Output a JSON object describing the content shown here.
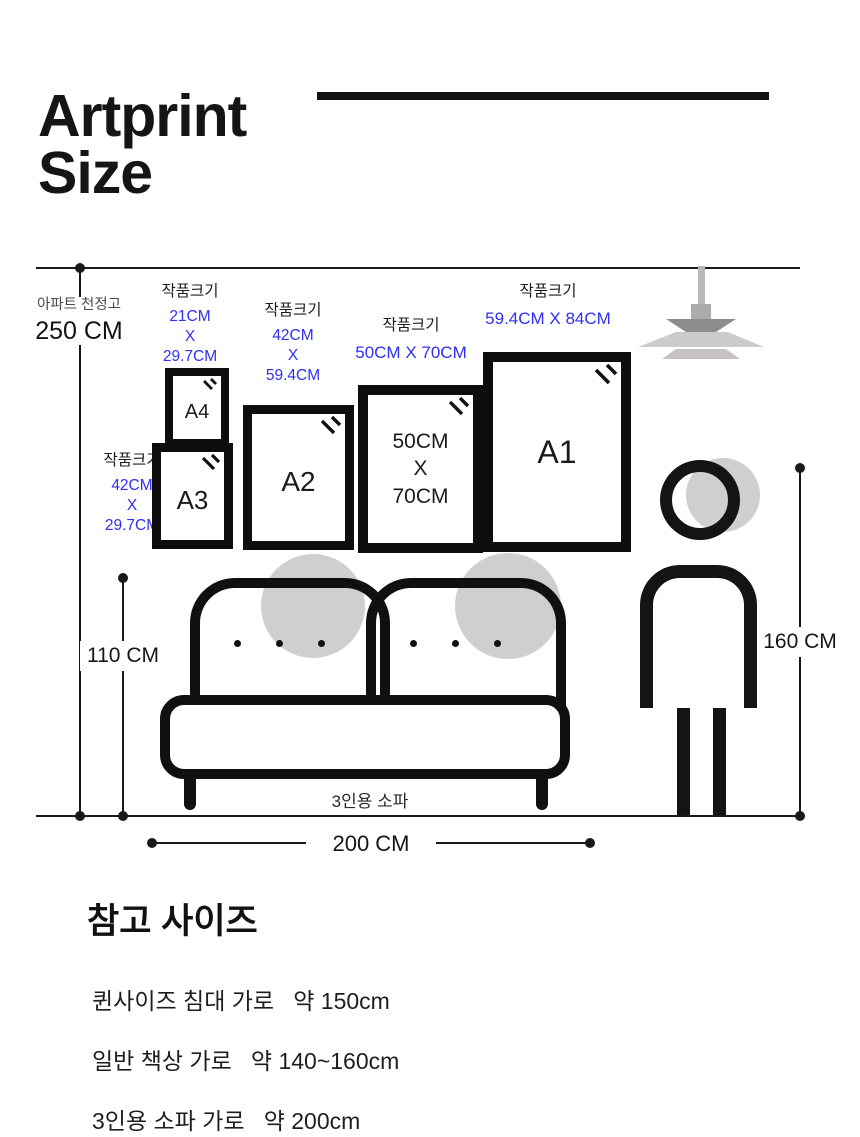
{
  "title": {
    "line1": "Artprint",
    "line2": "Size"
  },
  "colors": {
    "accent_blue": "#2f2ff2"
  },
  "diagram": {
    "ceiling_label": "아파트 천정고",
    "ceiling_height": "250 CM",
    "sofa_height": "110 CM",
    "person_height": "160 CM",
    "sofa_width": "200 CM",
    "sofa_caption": "3인용 소파",
    "frames": [
      {
        "name": "A4",
        "label": "작품크기",
        "size": "21CM\nX\n29.7CM",
        "display": "A4"
      },
      {
        "name": "A3",
        "label": "작품크기",
        "size": "42CM\nX\n29.7CM",
        "display": "A3"
      },
      {
        "name": "A2",
        "label": "작품크기",
        "size": "42CM\nX\n59.4CM",
        "display": "A2"
      },
      {
        "name": "50X70",
        "label": "작품크기",
        "size": "50CM X 70CM",
        "display": "50CM\nX\n70CM"
      },
      {
        "name": "A1",
        "label": "작품크기",
        "size": "59.4CM X 84CM",
        "display": "A1"
      }
    ]
  },
  "reference": {
    "heading": "참고 사이즈",
    "items": [
      "퀸사이즈 침대 가로   약 150cm",
      "일반 책상 가로   약 140~160cm",
      "3인용 소파 가로   약 200cm"
    ]
  }
}
